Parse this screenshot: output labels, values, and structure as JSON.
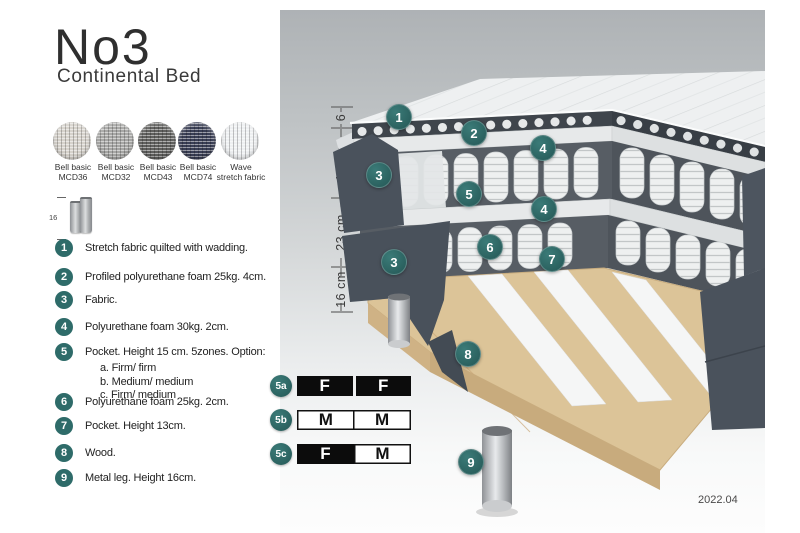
{
  "title": "No3",
  "subtitle": "Continental Bed",
  "swatches": [
    {
      "line1": "Bell basic",
      "line2": "MCD36",
      "color": "#d6d2cb"
    },
    {
      "line1": "Bell basic",
      "line2": "MCD32",
      "color": "#a7a7a5"
    },
    {
      "line1": "Bell basic",
      "line2": "MCD43",
      "color": "#60605e"
    },
    {
      "line1": "Bell basic",
      "line2": "MCD74",
      "color": "#3a3f56"
    },
    {
      "line1": "Wave",
      "line2": "stretch fabric",
      "color": "#eef0f2"
    }
  ],
  "leg_icon": {
    "dimension": "16"
  },
  "legend": {
    "items": [
      {
        "num": "1",
        "text": "Stretch fabric quilted with wadding."
      },
      {
        "num": "2",
        "text": "Profiled polyurethane foam 25kg. 4cm."
      },
      {
        "num": "3",
        "text": "Fabric."
      },
      {
        "num": "4",
        "text": "Polyurethane foam 30kg. 2cm."
      },
      {
        "num": "5",
        "text": "Pocket. Height 15 cm. 5zones. Option:",
        "options": [
          "a. Firm/ firm",
          "b. Medium/ medium",
          "c. Firm/ medium"
        ]
      },
      {
        "num": "6",
        "text": "Polyurethane foam 25kg. 2cm."
      },
      {
        "num": "7",
        "text": "Pocket. Height 13cm."
      },
      {
        "num": "8",
        "text": "Wood."
      },
      {
        "num": "9",
        "text": "Metal leg. Height 16cm."
      }
    ]
  },
  "diagram": {
    "dimensions": [
      "6",
      "19 cm",
      "23 cm",
      "16 cm"
    ],
    "markers": {
      "m1": "1",
      "m2": "2",
      "m3": "3",
      "m4": "4",
      "m5": "5",
      "m6": "6",
      "m7": "7",
      "m8": "8",
      "m9": "9"
    }
  },
  "firmness": {
    "rows": [
      {
        "id": "5a",
        "cells": [
          {
            "letter": "F",
            "fill": "dark"
          },
          {
            "letter": "F",
            "fill": "dark"
          }
        ]
      },
      {
        "id": "5b",
        "cells": [
          {
            "letter": "M",
            "fill": "light"
          },
          {
            "letter": "M",
            "fill": "light"
          }
        ]
      },
      {
        "id": "5c",
        "cells": [
          {
            "letter": "F",
            "fill": "dark"
          },
          {
            "letter": "M",
            "fill": "light"
          }
        ]
      }
    ]
  },
  "version": "2022.04",
  "colors": {
    "accent_teal": "#2e6b69",
    "bed_side": "#4a525c",
    "wood": "#dcc498",
    "table_black": "#0c0c0c",
    "panel_gray_top": "#aeb2b5"
  }
}
